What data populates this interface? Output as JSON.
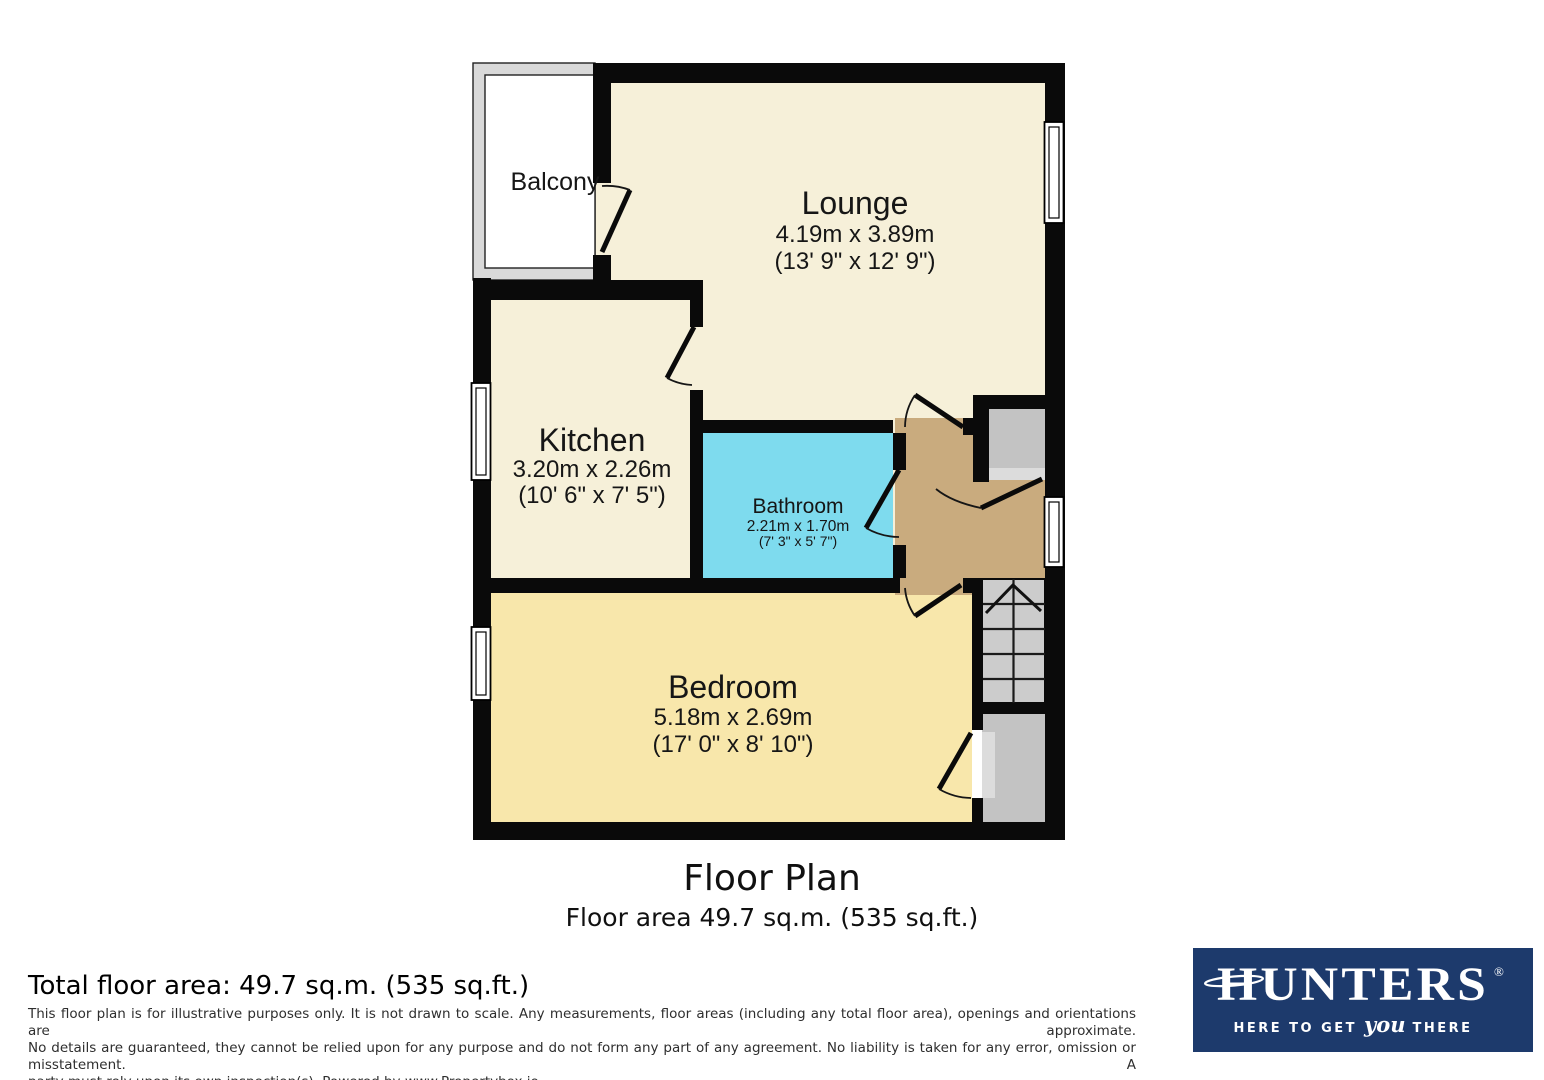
{
  "colors": {
    "wall": "#0a0a0a",
    "cream": "#f6f0d9",
    "bedroom": "#f8e7ab",
    "bathroom": "#7edbee",
    "hall": "#c9ab7e",
    "gray_room": "#c3c3c3",
    "threshold": "#dcdcdc",
    "stairs": "#cccccc",
    "balcony_wall": "#d9d9d9",
    "logo_bg": "#1d3a6c",
    "logo_text": "#ffffff"
  },
  "plan": {
    "balcony": {
      "label": "Balcony"
    },
    "rooms": {
      "lounge": {
        "name": "Lounge",
        "metric": "4.19m x 3.89m",
        "imperial": "(13' 9\" x 12' 9\")"
      },
      "kitchen": {
        "name": "Kitchen",
        "metric": "3.20m x 2.26m",
        "imperial": "(10' 6\" x 7' 5\")"
      },
      "bathroom": {
        "name": "Bathroom",
        "metric": "2.21m x 1.70m",
        "imperial": "(7' 3\" x 5' 7\")"
      },
      "bedroom": {
        "name": "Bedroom",
        "metric": "5.18m x 2.69m",
        "imperial": "(17' 0\" x 8' 10\")"
      }
    },
    "title": "Floor Plan",
    "subtitle": "Floor area 49.7 sq.m. (535 sq.ft.)"
  },
  "footer": {
    "total_area": "Total floor area: 49.7 sq.m. (535 sq.ft.)",
    "disclaimer": [
      "This floor plan is for illustrative purposes only. It is not drawn to scale. Any measurements, floor areas (including any total floor area), openings and orientations are approximate.",
      "No details are guaranteed, they cannot be relied upon for any purpose and do not form any part of any agreement. No liability is taken for any error, omission or misstatement. A",
      "party must rely upon its own inspection(s). Powered by www.Propertybox.io"
    ]
  },
  "logo": {
    "brand": "HUNTERS",
    "registered": "®",
    "tagline_pre": "HERE TO GET",
    "tagline_emph": "you",
    "tagline_post": "THERE"
  }
}
